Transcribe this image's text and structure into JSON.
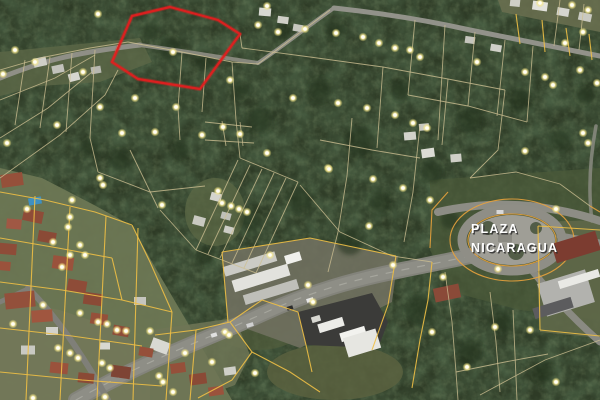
{
  "map": {
    "label": {
      "line1": "PLAZA",
      "line2": "NICARAGUA",
      "color": "#ffffff",
      "shadow": "#2e2e2e"
    },
    "colors": {
      "forest_base": "#2e3b26",
      "parcel_tan": "#cdbf92",
      "parcel_yellow": "#eebf45",
      "parcel_orange": "#e8a23c",
      "red_outline": "#e01f1f",
      "plaza_fill": "#9f9e96",
      "ring_road": "#8f8e86",
      "dot_core": "#fffef6",
      "roof_red": "#94503c",
      "pool_blue": "#3f90c2"
    },
    "red_parcel": {
      "points": "132,16 170,7 218,20 240,34 200,89 138,79 112,62"
    },
    "plaza": {
      "cx": 512,
      "cy": 240,
      "road_rx": 50,
      "road_ry": 31,
      "fill_rx": 43,
      "fill_ry": 25,
      "rings": [
        [
          62,
          41
        ],
        [
          44,
          26
        ]
      ],
      "spots": [
        [
          488,
          228,
          7
        ],
        [
          516,
          252,
          8
        ],
        [
          536,
          228,
          6
        ]
      ],
      "pad": [
        505,
        238,
        14,
        8
      ]
    },
    "ground": [
      {
        "points": "0,168 42,178 96,206 132,226 152,262 186,320 232,400 0,400",
        "c": "#6d7754",
        "o": 0.95
      },
      {
        "points": "0,300 60,310 120,330 150,360 150,400 0,400",
        "c": "#7a7a5e",
        "o": 0.5
      },
      {
        "points": "0,52 140,38 152,62 100,82 40,86 0,96",
        "c": "#5d6847",
        "o": 0.8
      },
      {
        "points": "498,0 600,0 600,32 502,12",
        "c": "#6b7050",
        "o": 0.85
      },
      {
        "e": 1,
        "cx": 215,
        "cy": 212,
        "rx": 30,
        "ry": 34,
        "c": "#5c6845",
        "o": 0.75
      },
      {
        "points": "430,180 600,168 600,320 520,310 452,292 430,250",
        "c": "#4b5a3a",
        "o": 0.75
      },
      {
        "e": 1,
        "cx": 335,
        "cy": 372,
        "rx": 68,
        "ry": 28,
        "c": "#5a6240",
        "o": 0.85
      },
      {
        "e": 1,
        "cx": 258,
        "cy": 330,
        "rx": 42,
        "ry": 20,
        "c": "#515d3c",
        "o": 0.7
      },
      {
        "points": "222,252 310,238 398,256 392,302 300,348 228,322",
        "c": "#70705f",
        "o": 0.9
      },
      {
        "points": "534,222 600,220 600,338 540,332",
        "c": "#5f6849",
        "o": 0.9
      },
      {
        "points": "150,330 235,318 250,355 235,385 195,400 150,400",
        "c": "#6e7656",
        "o": 0.85
      }
    ],
    "trees": [
      [
        170,
        48,
        11
      ],
      [
        205,
        62,
        9
      ],
      [
        150,
        30,
        8
      ],
      [
        260,
        120,
        13
      ],
      [
        320,
        90,
        12
      ],
      [
        360,
        142,
        15
      ],
      [
        300,
        200,
        13
      ],
      [
        432,
        172,
        11
      ],
      [
        470,
        120,
        13
      ],
      [
        520,
        100,
        11
      ],
      [
        180,
        150,
        9
      ],
      [
        120,
        160,
        11
      ],
      [
        250,
        222,
        11
      ],
      [
        350,
        242,
        13
      ],
      [
        420,
        310,
        15
      ],
      [
        470,
        352,
        13
      ],
      [
        543,
        372,
        11
      ],
      [
        90,
        148,
        9
      ],
      [
        282,
        32,
        8
      ],
      [
        380,
        202,
        11
      ],
      [
        502,
        322,
        11
      ],
      [
        560,
        140,
        10
      ],
      [
        585,
        95,
        9
      ],
      [
        240,
        90,
        9
      ],
      [
        205,
        255,
        9
      ],
      [
        335,
        30,
        9
      ],
      [
        400,
        90,
        10
      ],
      [
        450,
        220,
        9
      ]
    ],
    "roads": [
      {
        "d": "M0,78 C40,62 70,53 140,45",
        "w": 5,
        "c": "#8f8f86",
        "o": 1
      },
      {
        "d": "M140,45 C190,52 225,58 258,63",
        "w": 4,
        "c": "#8a8a80",
        "o": 0.95
      },
      {
        "d": "M258,63 C285,45 305,28 334,8",
        "w": 4,
        "c": "#8f8f86",
        "o": 1
      },
      {
        "d": "M334,8 C380,13 430,21 470,30 C520,40 560,48 600,56",
        "w": 5,
        "c": "#92928a",
        "o": 1
      },
      {
        "d": "M76,400 C150,358 210,338 262,314 C310,292 352,280 402,270 C432,264 452,260 470,256",
        "w": 16,
        "c": "#83837b",
        "o": 1
      },
      {
        "d": "M76,400 C150,358 210,338 262,314 C310,292 352,280 402,270 C432,264 452,260 470,256",
        "w": 12,
        "c": "#8e8e86",
        "o": 1
      },
      {
        "d": "M76,400 C150,358 210,338 262,314 C310,292 352,280 402,270 C432,264 452,260 470,256",
        "w": 1.2,
        "c": "#b5b5ad",
        "o": 0.6,
        "dash": "7 9"
      },
      {
        "d": "M438,212 C470,205 500,203 530,206 C555,209 580,214 600,221",
        "w": 8,
        "c": "#8d8d85",
        "o": 1
      },
      {
        "d": "M560,236 L600,243",
        "w": 7,
        "c": "#8d8d85",
        "o": 1
      },
      {
        "d": "M530,268 C548,290 566,312 600,342",
        "w": 7,
        "c": "#8a8a82",
        "o": 1
      },
      {
        "d": "M592,221 C588,190 590,158 596,126",
        "w": 3.5,
        "c": "#8d8d85",
        "o": 0.8
      },
      {
        "d": "M28,288 C55,315 80,350 108,400",
        "w": 6,
        "c": "#7f7f78",
        "o": 1
      },
      {
        "d": "M0,302 L30,288",
        "w": 5,
        "c": "#7f7f78",
        "o": 1
      }
    ],
    "parcel_lines_tan": [
      "0,70 45,57 90,48 128,42",
      "0,100 55,78 95,55",
      "0,138 48,108 92,72",
      "0,178 60,135 105,95 118,70",
      "25,60 15,125",
      "50,57 40,128",
      "72,53 66,132",
      "95,50 90,138 98,172",
      "118,45 112,62",
      "98,172 150,192 205,186",
      "128,42 182,52 232,62 258,64",
      "232,62 236,120 240,158",
      "258,64 298,34 330,10",
      "182,52 178,108 180,140",
      "206,58 202,112",
      "205,122 252,127",
      "205,140 254,143",
      "222,121 226,146",
      "240,122 243,146",
      "240,158 298,182",
      "238,160 196,250",
      "250,165 208,254",
      "262,169 220,258",
      "274,173 232,263",
      "286,178 244,268",
      "298,182 256,273",
      "196,250 256,273",
      "160,210 196,250",
      "130,150 158,208",
      "242,48 310,57 383,67 448,79 505,90",
      "240,34 242,48",
      "415,20 408,95",
      "445,25 438,140",
      "475,32 468,106",
      "505,40 497,116",
      "533,46 527,122",
      "408,95 468,106 527,122",
      "560,0 554,46",
      "584,4 579,50",
      "383,67 377,148",
      "320,140 372,150 420,158",
      "352,118 347,176 338,232",
      "420,125 413,192 404,242",
      "300,185 340,232 392,256 432,262",
      "448,79 442,145",
      "505,90 498,150 470,178",
      "470,178 516,172 560,184 590,206",
      "338,232 328,272",
      "445,272 452,322 456,372 458,400",
      "456,372 505,362 548,354",
      "490,292 496,342 500,392",
      "513,310 517,400",
      "480,395 545,360 600,340"
    ],
    "parcel_lines_yellow": [
      "0,192 45,200 95,212 132,225",
      "0,238 58,248 112,258",
      "0,282 62,290 122,300 172,312",
      "0,328 72,336 142,346",
      "0,372 82,380 162,386",
      "35,196 26,400",
      "70,207 60,400",
      "106,216 97,400",
      "138,228 133,400",
      "172,312 166,400",
      "132,225 150,262 172,312",
      "112,258 122,300",
      "155,335 196,330 190,400",
      "196,330 230,322 252,352 232,380 198,398",
      "230,322 262,300 298,312",
      "222,252 310,238 396,256",
      "222,252 228,322",
      "396,256 388,305 372,350",
      "298,312 306,345 312,372",
      "252,352 290,372 320,392",
      "432,262 428,300 420,340 412,388",
      "538,226 600,230",
      "538,226 540,330",
      "540,330 600,336",
      "520,44 516,14",
      "545,52 542,20",
      "570,56 566,28",
      "592,60 589,34"
    ],
    "parcel_lines_orange": [
      "448,192 432,210 430,248",
      "590,206 600,212"
    ],
    "polys": [
      {
        "points": "298,312 372,293 388,322 378,348 306,345",
        "c": "#3b3b39",
        "o": 1
      }
    ],
    "buildings": [
      [
        40,
        62,
        13,
        9,
        -12,
        "#cfcfc8"
      ],
      [
        58,
        69,
        12,
        8,
        -12,
        "#c2c2bb"
      ],
      [
        74,
        77,
        11,
        8,
        -15,
        "#d6d6cf"
      ],
      [
        96,
        70,
        10,
        7,
        -10,
        "#b8b8b0"
      ],
      [
        265,
        12,
        12,
        8,
        5,
        "#d8d8d2"
      ],
      [
        283,
        20,
        11,
        7,
        8,
        "#cfcfc7"
      ],
      [
        298,
        28,
        10,
        7,
        10,
        "#c6c6be"
      ],
      [
        515,
        3,
        10,
        7,
        6,
        "#cfcfc7"
      ],
      [
        540,
        6,
        15,
        9,
        8,
        "#e2e2dc"
      ],
      [
        563,
        12,
        12,
        8,
        10,
        "#d5d5cf"
      ],
      [
        585,
        17,
        13,
        8,
        12,
        "#c9c9c1"
      ],
      [
        470,
        40,
        10,
        7,
        8,
        "#c5c5bd"
      ],
      [
        496,
        48,
        11,
        7,
        10,
        "#d0d0c8"
      ],
      [
        424,
        127,
        10,
        7,
        -5,
        "#c8c8c0"
      ],
      [
        410,
        136,
        12,
        8,
        -5,
        "#d2d2cb"
      ],
      [
        428,
        153,
        13,
        9,
        -8,
        "#dcdcd5"
      ],
      [
        456,
        158,
        11,
        8,
        -5,
        "#cfcfc7"
      ],
      [
        216,
        197,
        11,
        8,
        15,
        "#d4d4cd"
      ],
      [
        199,
        221,
        12,
        9,
        15,
        "#c9c9c1"
      ],
      [
        226,
        216,
        10,
        7,
        15,
        "#c0c0b8"
      ],
      [
        229,
        230,
        10,
        7,
        15,
        "#cdcdc5"
      ],
      [
        250,
        264,
        54,
        10,
        -17,
        "#cbcbc5"
      ],
      [
        261,
        278,
        58,
        12,
        -17,
        "#e2e2dd"
      ],
      [
        271,
        292,
        56,
        10,
        -17,
        "#bfbfb9"
      ],
      [
        293,
        258,
        16,
        9,
        -17,
        "#f0f0ec"
      ],
      [
        331,
        325,
        26,
        9,
        -17,
        "#ecece8"
      ],
      [
        353,
        334,
        26,
        9,
        -17,
        "#f2f2ee"
      ],
      [
        316,
        319,
        9,
        6,
        -17,
        "#d8d8d2"
      ],
      [
        447,
        293,
        26,
        14,
        -12,
        "#8a4a38"
      ],
      [
        362,
        343,
        34,
        20,
        -17,
        "#e6e6e1"
      ],
      [
        160,
        346,
        18,
        12,
        20,
        "#d9d9d3"
      ],
      [
        12,
        180,
        22,
        13,
        -8,
        "#95503a"
      ],
      [
        33,
        216,
        20,
        12,
        12,
        "#8e4c38"
      ],
      [
        14,
        224,
        15,
        10,
        5,
        "#a05844"
      ],
      [
        47,
        237,
        18,
        11,
        10,
        "#8a4a36"
      ],
      [
        63,
        263,
        21,
        13,
        8,
        "#9a523c"
      ],
      [
        77,
        286,
        19,
        12,
        10,
        "#8e4c38"
      ],
      [
        20,
        300,
        30,
        16,
        -6,
        "#93503b"
      ],
      [
        42,
        316,
        21,
        12,
        -4,
        "#a0563f"
      ],
      [
        93,
        299,
        19,
        12,
        8,
        "#8a4a36"
      ],
      [
        99,
        319,
        17,
        11,
        8,
        "#95503a"
      ],
      [
        121,
        331,
        16,
        10,
        10,
        "#8e4c38"
      ],
      [
        59,
        368,
        18,
        11,
        6,
        "#9a523c"
      ],
      [
        86,
        378,
        16,
        10,
        6,
        "#8a4a36"
      ],
      [
        121,
        372,
        19,
        12,
        8,
        "#7e4434"
      ],
      [
        146,
        352,
        14,
        9,
        10,
        "#95503a"
      ],
      [
        28,
        350,
        14,
        9,
        0,
        "#c9c9c2"
      ],
      [
        52,
        331,
        12,
        8,
        0,
        "#d2d2cb"
      ],
      [
        105,
        346,
        10,
        7,
        0,
        "#d8d8d1"
      ],
      [
        140,
        301,
        12,
        8,
        0,
        "#c5c5be"
      ],
      [
        8,
        249,
        17,
        11,
        5,
        "#8e4c38"
      ],
      [
        4,
        266,
        13,
        9,
        5,
        "#9a523c"
      ],
      [
        178,
        368,
        15,
        10,
        -8,
        "#95503a"
      ],
      [
        198,
        379,
        17,
        11,
        -8,
        "#8a4a36"
      ],
      [
        216,
        391,
        15,
        9,
        -8,
        "#9a523c"
      ],
      [
        230,
        371,
        12,
        8,
        -8,
        "#cfcfc8"
      ],
      [
        35,
        201,
        13,
        7,
        -10,
        "#3f90c2"
      ],
      [
        576,
        247,
        46,
        20,
        -17,
        "#7c3c30"
      ],
      [
        566,
        293,
        50,
        34,
        -17,
        "#b2b2ae"
      ],
      [
        579,
        279,
        42,
        8,
        -17,
        "#e9e9e5"
      ],
      [
        553,
        308,
        40,
        11,
        -17,
        "#5c5c5e"
      ],
      [
        310,
        300,
        7,
        4,
        -17,
        "#e8e8e8"
      ],
      [
        290,
        308,
        6,
        4,
        -17,
        "#2c2c2c"
      ],
      [
        250,
        325,
        7,
        4,
        -17,
        "#d0d0d0"
      ],
      [
        500,
        212,
        7,
        4,
        0,
        "#d8d8d8"
      ],
      [
        214,
        335,
        6,
        4,
        -17,
        "#e0e0e0"
      ]
    ],
    "dots": [
      [
        98,
        14
      ],
      [
        15,
        50
      ],
      [
        35,
        62
      ],
      [
        3,
        74
      ],
      [
        83,
        72
      ],
      [
        100,
        107
      ],
      [
        135,
        98
      ],
      [
        173,
        52
      ],
      [
        230,
        80
      ],
      [
        176,
        107
      ],
      [
        57,
        125
      ],
      [
        122,
        133
      ],
      [
        7,
        143
      ],
      [
        100,
        178
      ],
      [
        267,
        6
      ],
      [
        258,
        25
      ],
      [
        278,
        32
      ],
      [
        305,
        29
      ],
      [
        336,
        33
      ],
      [
        363,
        37
      ],
      [
        379,
        43
      ],
      [
        395,
        48
      ],
      [
        293,
        98
      ],
      [
        338,
        103
      ],
      [
        367,
        108
      ],
      [
        410,
        50
      ],
      [
        420,
        57
      ],
      [
        477,
        62
      ],
      [
        525,
        72
      ],
      [
        545,
        77
      ],
      [
        540,
        3
      ],
      [
        572,
        5
      ],
      [
        588,
        10
      ],
      [
        565,
        43
      ],
      [
        583,
        32
      ],
      [
        580,
        70
      ],
      [
        597,
        83
      ],
      [
        553,
        85
      ],
      [
        395,
        115
      ],
      [
        413,
        123
      ],
      [
        427,
        128
      ],
      [
        583,
        133
      ],
      [
        588,
        143
      ],
      [
        525,
        151
      ],
      [
        155,
        132
      ],
      [
        202,
        135
      ],
      [
        223,
        127
      ],
      [
        240,
        134
      ],
      [
        267,
        153
      ],
      [
        328,
        168
      ],
      [
        162,
        205
      ],
      [
        218,
        191
      ],
      [
        222,
        203
      ],
      [
        231,
        206
      ],
      [
        239,
        209
      ],
      [
        247,
        212
      ],
      [
        329,
        169
      ],
      [
        373,
        179
      ],
      [
        403,
        188
      ],
      [
        430,
        200
      ],
      [
        369,
        226
      ],
      [
        556,
        209
      ],
      [
        498,
        269
      ],
      [
        443,
        277
      ],
      [
        72,
        200
      ],
      [
        27,
        209
      ],
      [
        70,
        217
      ],
      [
        53,
        242
      ],
      [
        80,
        245
      ],
      [
        68,
        227
      ],
      [
        70,
        255
      ],
      [
        62,
        267
      ],
      [
        85,
        255
      ],
      [
        103,
        185
      ],
      [
        13,
        324
      ],
      [
        43,
        305
      ],
      [
        80,
        313
      ],
      [
        98,
        322
      ],
      [
        107,
        324
      ],
      [
        117,
        330
      ],
      [
        126,
        331
      ],
      [
        150,
        331
      ],
      [
        58,
        348
      ],
      [
        70,
        353
      ],
      [
        78,
        358
      ],
      [
        102,
        363
      ],
      [
        110,
        368
      ],
      [
        105,
        397
      ],
      [
        159,
        376
      ],
      [
        33,
        398
      ],
      [
        173,
        392
      ],
      [
        270,
        255
      ],
      [
        308,
        285
      ],
      [
        313,
        302
      ],
      [
        393,
        265
      ],
      [
        225,
        332
      ],
      [
        185,
        353
      ],
      [
        212,
        362
      ],
      [
        229,
        335
      ],
      [
        163,
        382
      ],
      [
        255,
        373
      ],
      [
        432,
        332
      ],
      [
        495,
        327
      ],
      [
        530,
        330
      ],
      [
        467,
        367
      ],
      [
        556,
        382
      ]
    ]
  }
}
